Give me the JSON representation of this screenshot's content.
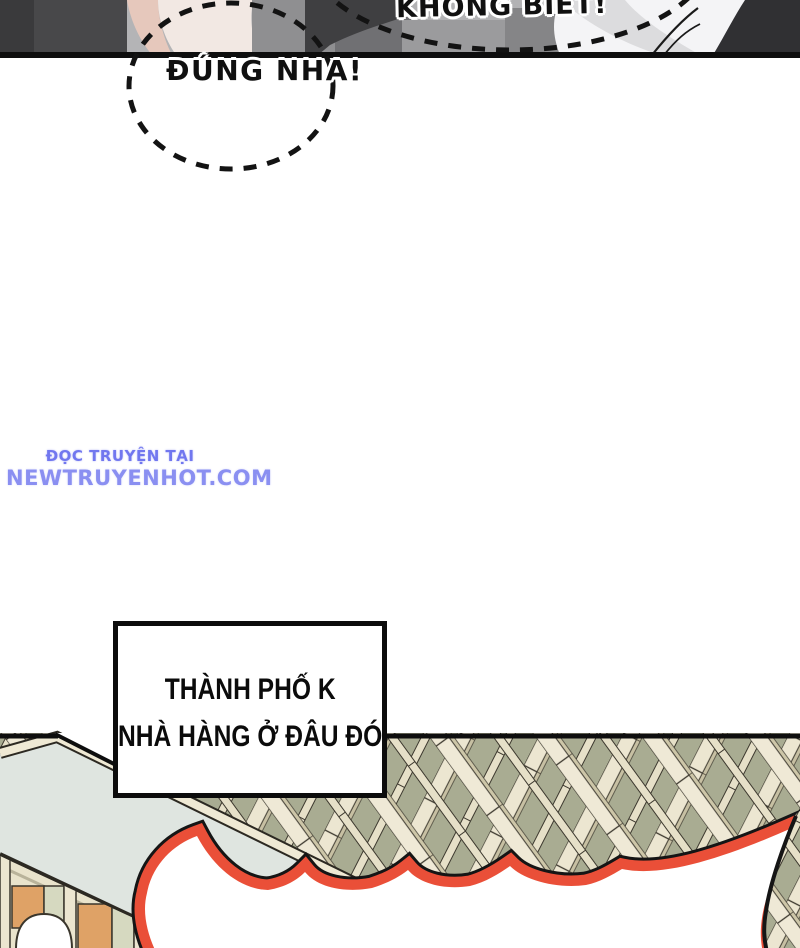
{
  "page": {
    "width": 800,
    "height": 948,
    "background": "#ffffff"
  },
  "top_panel": {
    "bubbles": [
      {
        "name": "khong-biet",
        "text": "KHÔNG BIẾT!",
        "style": "dashed-ellipse"
      },
      {
        "name": "dung-nha",
        "text": "ĐÚNG NHA!",
        "style": "dashed-ellipse"
      }
    ]
  },
  "watermark": {
    "line1": "ĐỌC TRUYỆN TẠI",
    "line2": "NEWTRUYENHOT.COM"
  },
  "caption_box": {
    "line1": "THÀNH PHỐ K",
    "line2": "NHÀ HÀNG Ở ĐÂU ĐÓ"
  },
  "palette": {
    "accent_red": "#ea4f38",
    "watermark_blue": "#7177ef",
    "watermark_blue2": "#8a8ff1",
    "lattice_olive": "#a9ac92",
    "beam_cream": "#ece6d1",
    "plane_green": "#dfe5e0",
    "wood_tan": "#dfa266",
    "ink_black": "#0e0e0e"
  }
}
